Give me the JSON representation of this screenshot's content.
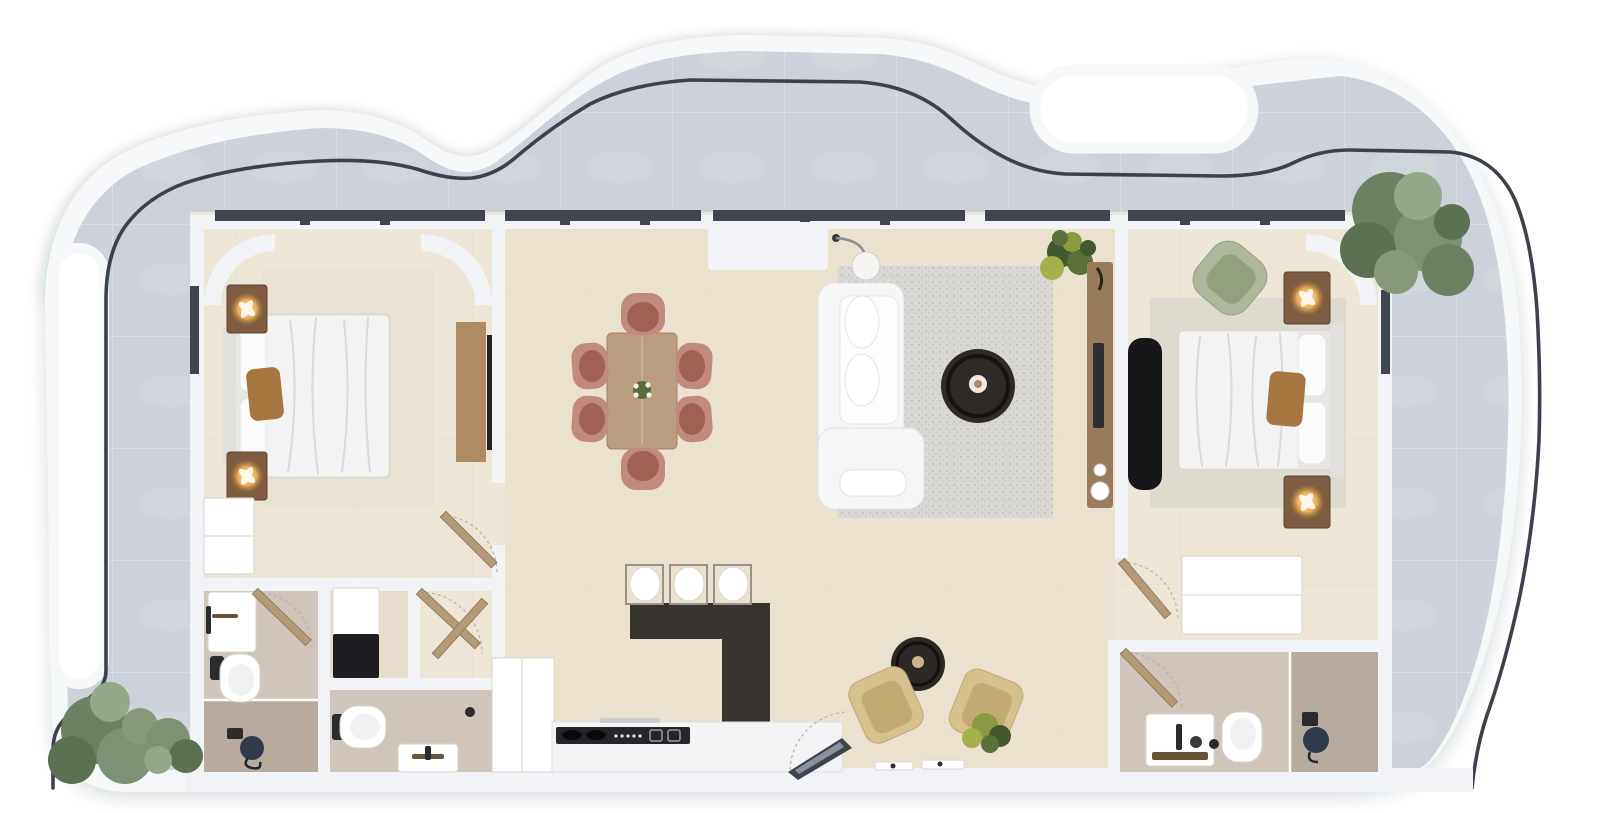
{
  "scene": {
    "kind": "apartment-floor-plan-3d-render",
    "orientation": "top-down"
  },
  "colors": {
    "page_bg": "#ffffff",
    "band": "#f7f8fa",
    "terrace_tile": "#cdd1d9",
    "terrace_tile_dark": "#c2c7d0",
    "railing": "#3c424c",
    "wall": "#f2f3f6",
    "window_frame": "#41454d",
    "floor": "#ede5d5",
    "floor_warm": "#e9dfcc",
    "bath_floor": "#cfc5bb",
    "shower_floor": "#b7aba0",
    "rug_bedroom": "#e9e2d3",
    "rug_living": "#d9d8d5",
    "rug_bedroom2": "#dedacf",
    "sofa": "#f6f6f7",
    "coffee_table": "#2e2a27",
    "island": "#37332f",
    "counter": "#f4f4f6",
    "cooktop": "#26262a",
    "dining_table": "#bb9e80",
    "chair_shell": "#c08a7c",
    "chair_seat": "#9e6152",
    "nightstand": "#7d5c41",
    "lamp_glow": "#ffcf8f",
    "bed_linen": "#f3f3f4",
    "pillow_accent": "#a5763f",
    "headboard": "#e2e0dc",
    "green_chair": "#aeb799",
    "green_chair_seat": "#93a07c",
    "console": "#9a7b5c",
    "tv_panel": "#17171a",
    "door": "#b49a77",
    "tan_chair": "#d5c08e",
    "tan_chair_seat": "#c3aa72",
    "plant_dark": "#42582f",
    "plant_light": "#a3b04b",
    "tree": "#6d8162",
    "tree_light": "#93a887",
    "entry_glass": "#3e444d"
  },
  "rooms": [
    {
      "id": "terrace",
      "items": [
        "curved-balcony",
        "glass-railing",
        "tree",
        "shrub",
        "shrub"
      ]
    },
    {
      "id": "bedroom-left",
      "items": [
        "double-bed",
        "accent-pillow",
        "nightstand-with-lamp",
        "nightstand-with-lamp",
        "area-rug",
        "dresser",
        "desk",
        "tv"
      ]
    },
    {
      "id": "bathroom-left",
      "items": [
        "vanity-sink",
        "toilet",
        "walk-in-shower",
        "shower-stool"
      ]
    },
    {
      "id": "laundry-closet",
      "items": [
        "washing-machine"
      ]
    },
    {
      "id": "hall-bathroom",
      "items": [
        "toilet",
        "vanity-sink"
      ]
    },
    {
      "id": "kitchen",
      "items": [
        "island-counter",
        "bar-stool",
        "bar-stool",
        "bar-stool",
        "cooktop",
        "tall-cabinet",
        "base-counter"
      ]
    },
    {
      "id": "dining",
      "items": [
        "dining-table",
        "dining-chair",
        "dining-chair",
        "dining-chair",
        "dining-chair",
        "dining-chair",
        "dining-chair",
        "centerpiece"
      ]
    },
    {
      "id": "living",
      "items": [
        "l-shaped-sofa",
        "coffee-table",
        "floor-lamp",
        "media-console",
        "potted-plant",
        "wall-unit",
        "lounge-chair",
        "lounge-chair",
        "side-table",
        "potted-plant",
        "entry-door",
        "floor-trays"
      ]
    },
    {
      "id": "bedroom-right",
      "items": [
        "double-bed",
        "accent-pillow",
        "nightstand-with-lamp",
        "nightstand-with-lamp",
        "accent-armchair",
        "area-rug",
        "tv-panel",
        "dresser"
      ]
    },
    {
      "id": "bathroom-right",
      "items": [
        "vanity-sink",
        "toilet",
        "shower",
        "stool"
      ]
    }
  ]
}
